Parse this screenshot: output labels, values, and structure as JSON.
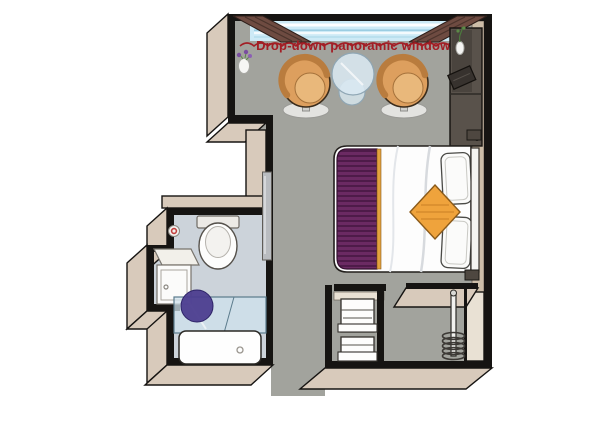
{
  "window_label": "Drop-down panoramic windows",
  "colors": {
    "background": "#ffffff",
    "wall_line": "#161412",
    "wall_face": "#d8cabb",
    "wall_face_light": "#e9e1d4",
    "floor_main": "#a2a39d",
    "floor_bath": "#ccd3da",
    "window_glass": "#cdeaf6",
    "window_streak": "#ffffff",
    "valance": "#6e4b41",
    "label_red": "#a21e25",
    "right_ledge": "#cdbda8",
    "chair_body": "#dd9f5e",
    "chair_seat": "#e9b87b",
    "chair_back": "#b97c3e",
    "chair_base": "#e3e3e0",
    "table_glass": "#d9e8f1",
    "bed_white": "#fdfdfd",
    "runner_purple": "#6b2a63",
    "runner_stripe": "#4e1b49",
    "runner_edge": "#e2a23e",
    "cushion_orange": "#efa33c",
    "headboard": "#f5f4f1",
    "desk_dark": "#59524b",
    "lamp_dark": "#4e4740",
    "stool_purple": "#4c3d8f",
    "shower_glass": "#cfe2ec",
    "fixture_white": "#fbfbfa",
    "mirror_gray": "#b9bcc0"
  }
}
